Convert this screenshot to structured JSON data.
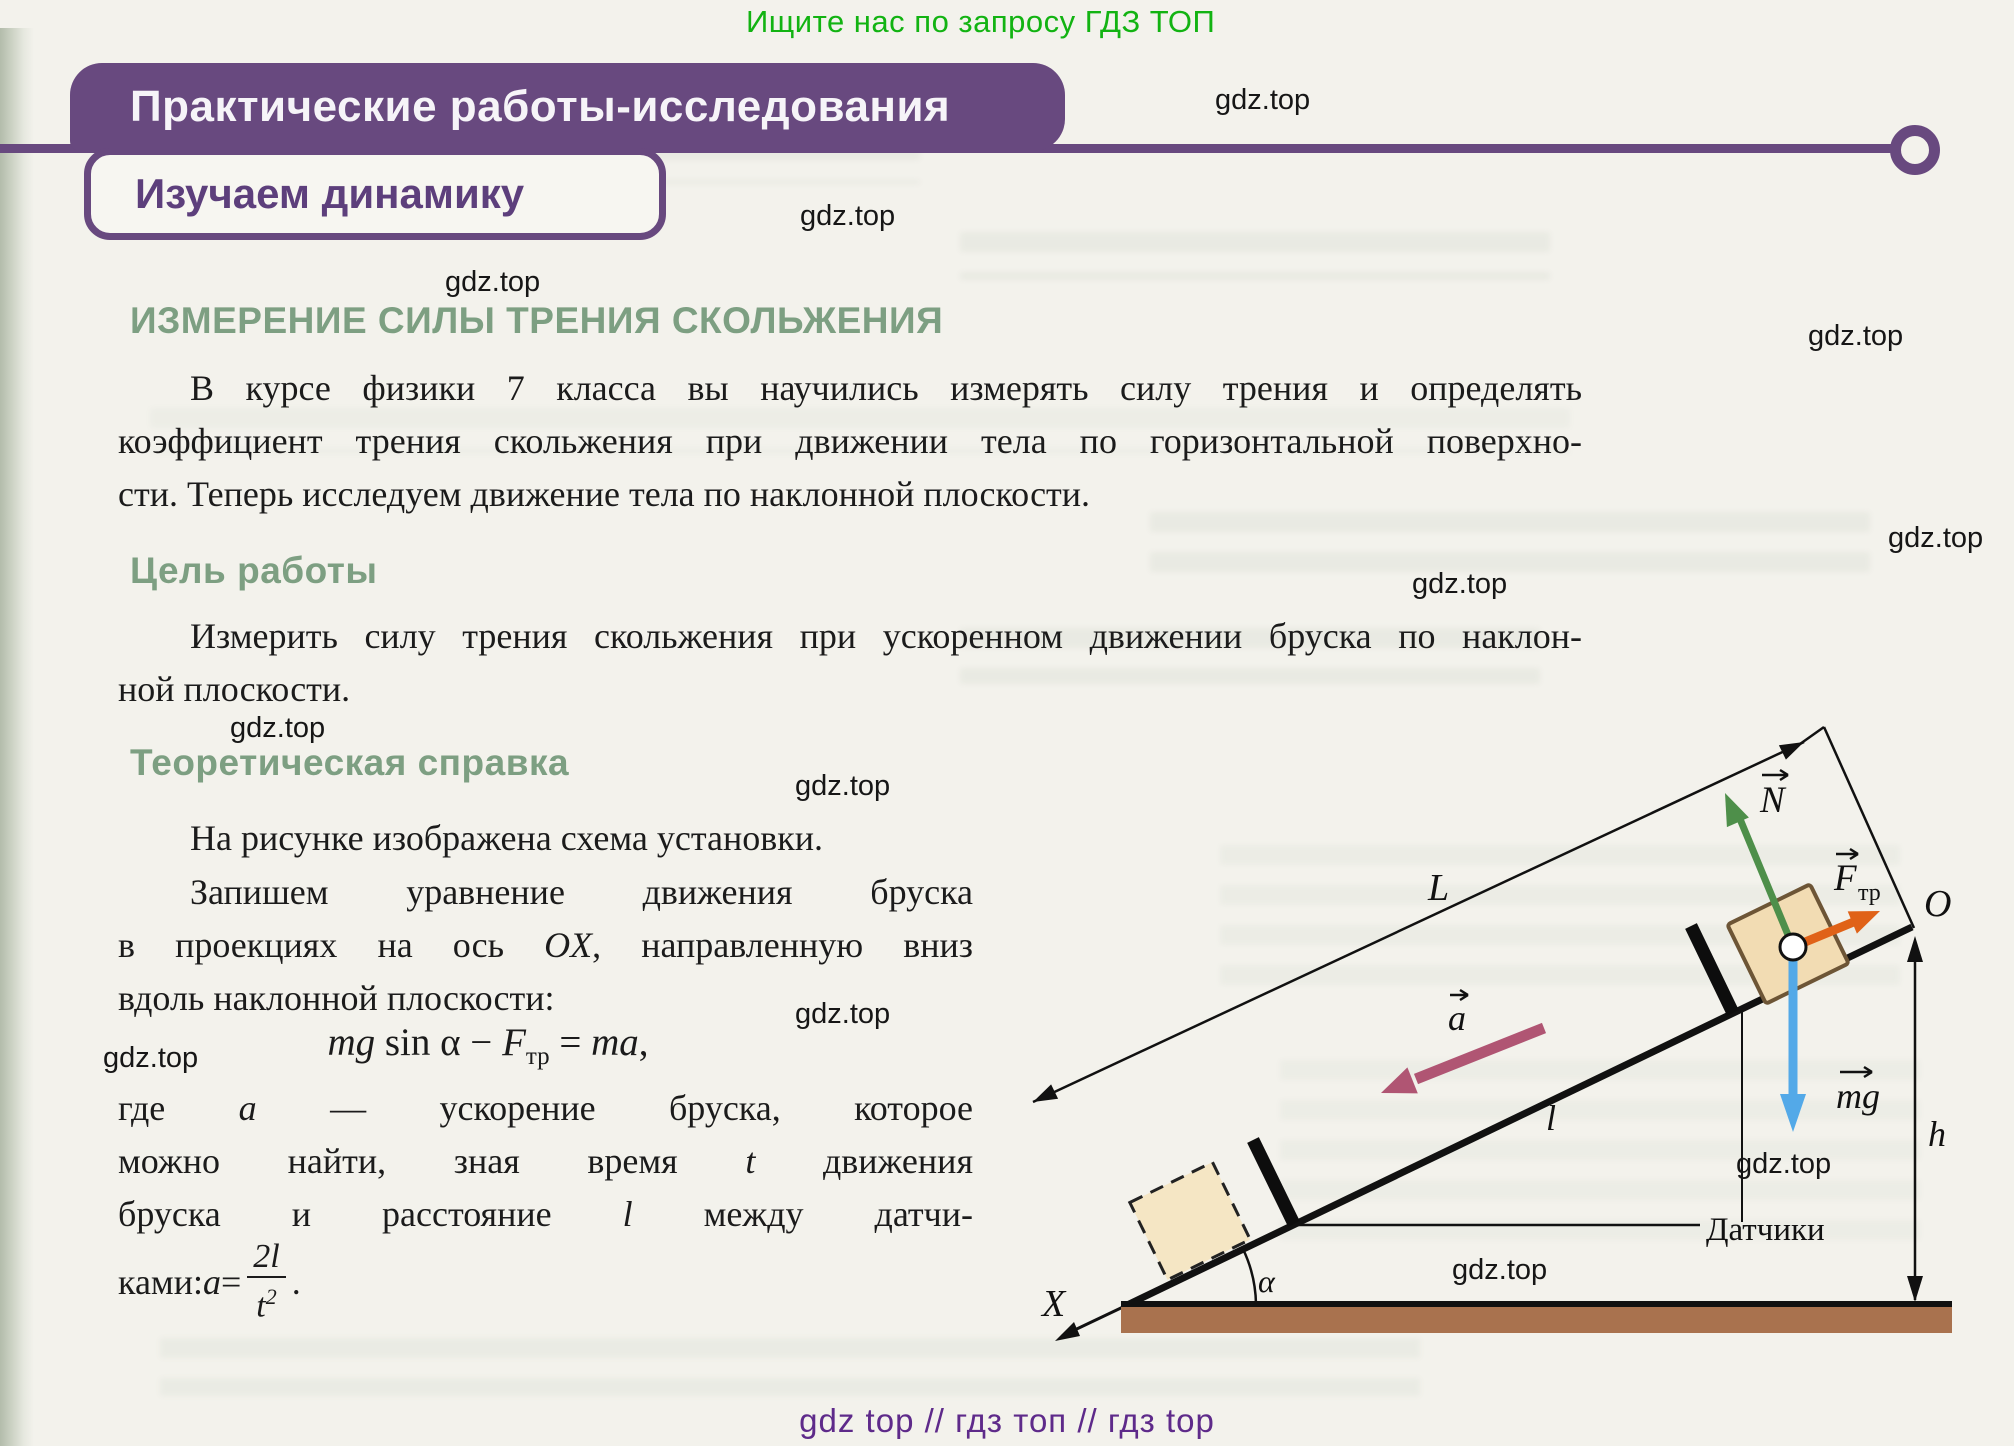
{
  "page": {
    "promo_top": "Ищите нас по запросу ГДЗ ТОП",
    "watermark": "gdz.top",
    "footer": "gdz top  //  гдз топ  //  гдз top"
  },
  "header": {
    "banner": "Практические работы-исследования",
    "subbanner": "Изучаем динамику"
  },
  "content": {
    "title": "ИЗМЕРЕНИЕ СИЛЫ ТРЕНИЯ СКОЛЬЖЕНИЯ",
    "intro": {
      "l1": "В курсе физики 7 класса вы научились измерять силу трения и определять",
      "l2": "коэффициент трения скольжения при движении тела по горизонтальной поверхно-",
      "l3": "сти. Теперь исследуем движение тела по наклонной плоскости."
    },
    "goal_heading": "Цель работы",
    "goal": {
      "l1": "Измерить силу трения скольжения при ускоренном движении бруска по наклон-",
      "l2": "ной плоскости."
    },
    "theory_heading": "Теоретическая справка",
    "theory": {
      "p1": "На рисунке изображена схема установки.",
      "p2_l1": "Запишем уравнение движения бруска",
      "p2_l2a": "в проекциях на ось ",
      "p2_l2b": "OX",
      "p2_l2c": ", направленную вниз",
      "p2_l3": "вдоль наклонной плоскости:",
      "formula": {
        "mg": "mg",
        "sin": " sin α − ",
        "f": "F",
        "f_sub": "тр",
        "eq": " = ",
        "ma": "ma",
        "comma": ","
      },
      "p4_l1a": "где ",
      "p4_l1b": "a",
      "p4_l1c": " — ускорение бруска, которое",
      "p4_l2a": "можно найти, зная время ",
      "p4_l2b": "t",
      "p4_l2c": " движения",
      "p4_l3a": "бруска и расстояние ",
      "p4_l3b": "l",
      "p4_l3c": " между датчи-",
      "p4_l4a": "ками: ",
      "p4_l4b": "a",
      "p4_l4c": " = ",
      "frac_num": "2l",
      "frac_den_base": "t",
      "frac_den_exp": "2",
      "p4_end": "."
    }
  },
  "diagram": {
    "labels": {
      "length": "L",
      "origin": "O",
      "height": "h",
      "distance": "l",
      "axis": "X",
      "angle": "α",
      "sensors": "Датчики",
      "normal": "N",
      "friction": "F",
      "friction_sub": "тр",
      "acceleration": "a",
      "gravity": "mg"
    }
  }
}
